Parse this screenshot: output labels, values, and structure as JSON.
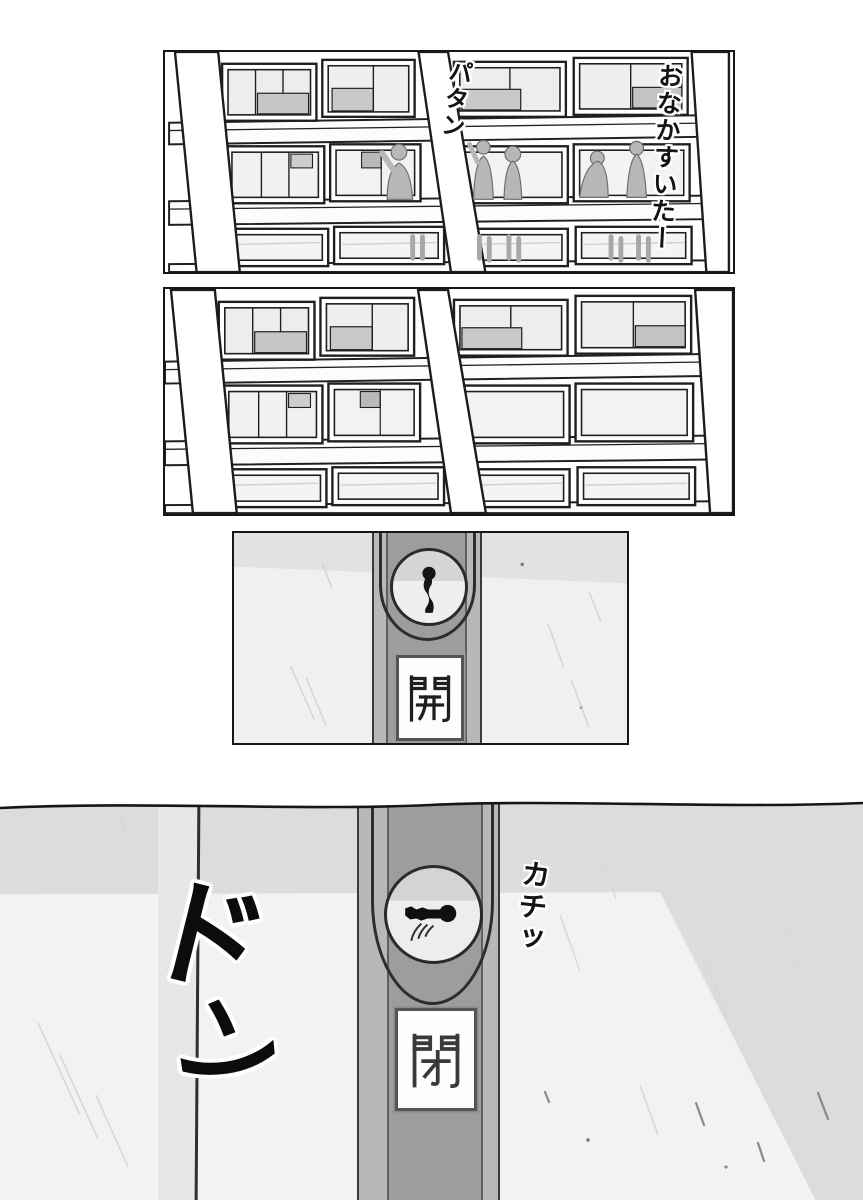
{
  "page": {
    "type": "manga-page",
    "background": "#ffffff",
    "ink": "#161616"
  },
  "panel1": {
    "description": "school building exterior, students silhouetted in corridor windows",
    "sfx_window_close": "パタン",
    "speech_hungry": "おなかすいたー"
  },
  "panel2": {
    "description": "same school building exterior, corridor now empty"
  },
  "panel3": {
    "description": "close-up of window crescent lock, keyhole vertical (unlocked)",
    "sign_label": "開"
  },
  "panel4": {
    "description": "wide close-up of the lock just turned shut",
    "sign_label": "閉",
    "sfx_click": "カチッ",
    "sfx_bang_char1": "ド",
    "sfx_bang_char2": "ン"
  },
  "colors": {
    "wall": "#f2f2f2",
    "wall_shadow": "#dcdcdc",
    "lock_strip": "#b8b8b8",
    "lock_strip_inner": "#9d9d9d",
    "glass": "#efefef",
    "silhouette": "#b7b7b7",
    "sign_background": "#fdfdfd"
  }
}
